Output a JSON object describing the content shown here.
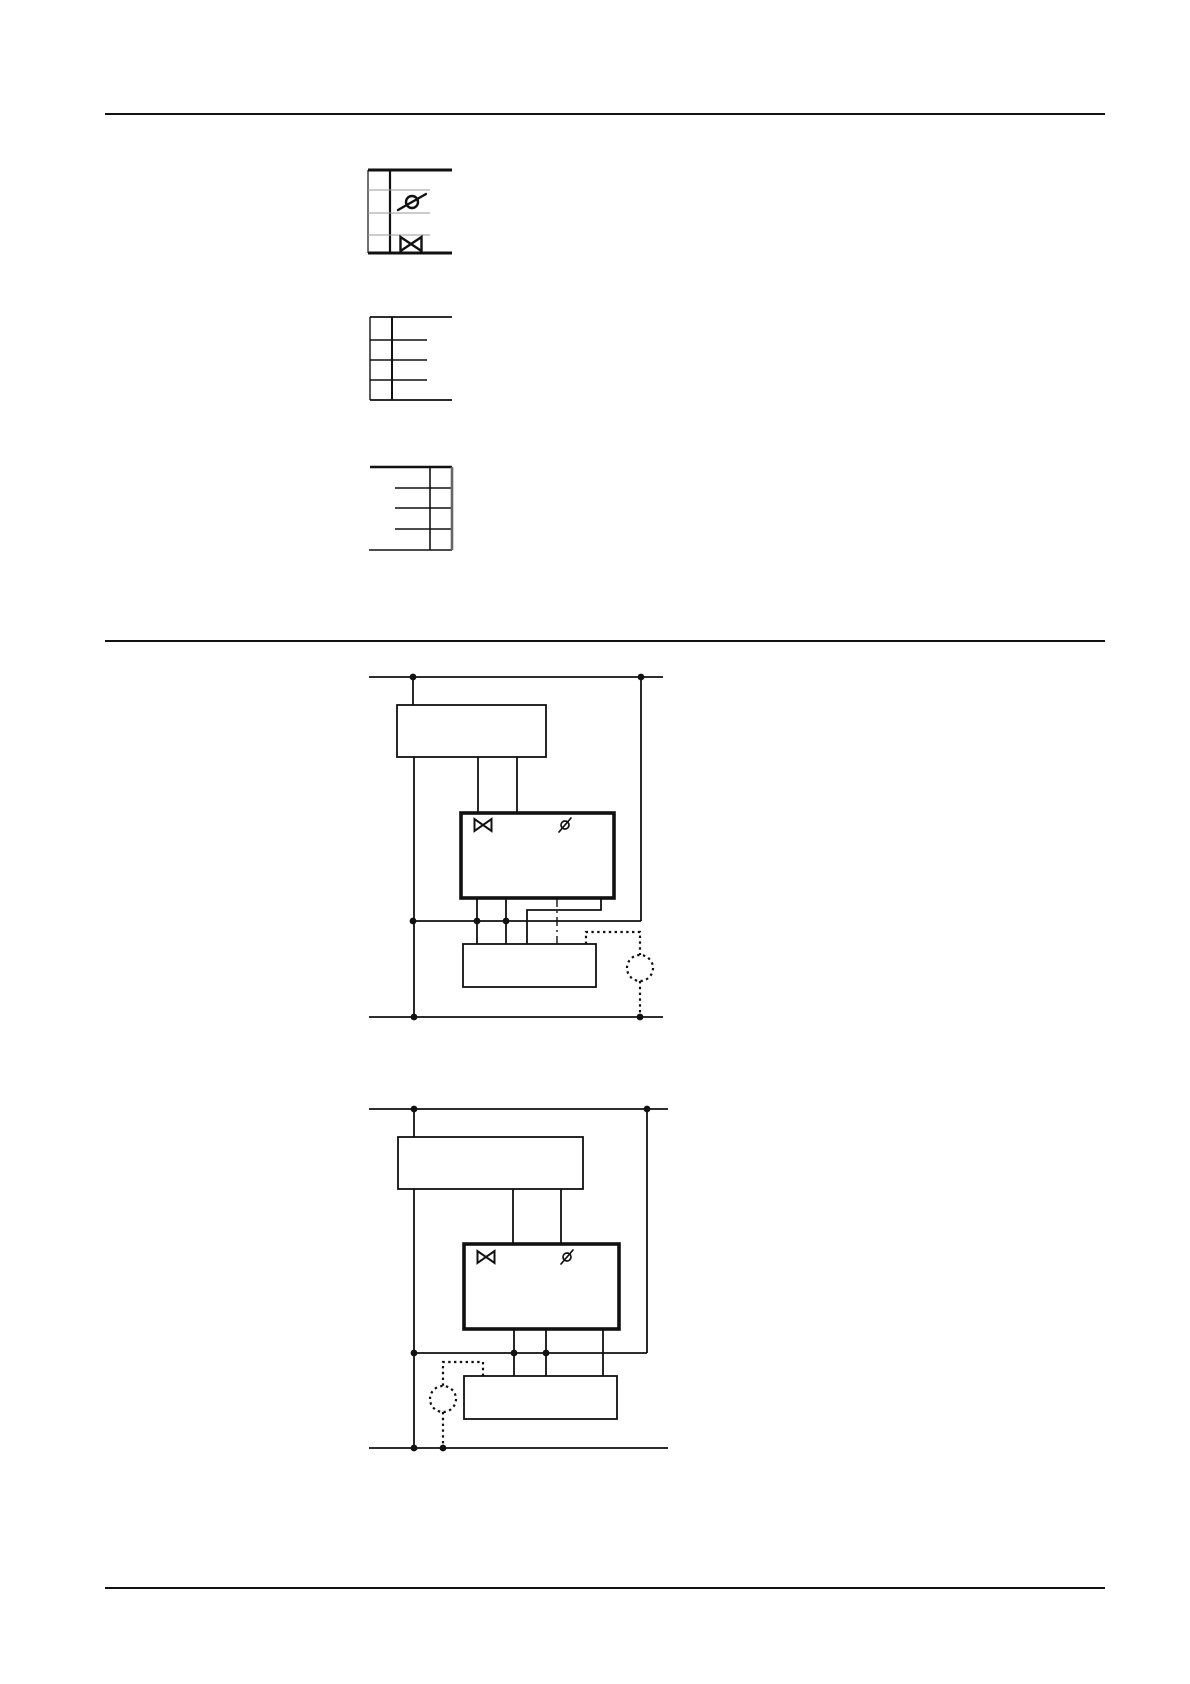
{
  "page": {
    "width": 1190,
    "height": 1684,
    "background": "#ffffff",
    "ink_color": "#111111",
    "muted_line_color": "#9a9a9a"
  },
  "section_dividers": [
    {
      "name": "divider-top",
      "x1": 105,
      "y": 114,
      "x2": 1105,
      "sw": 2
    },
    {
      "name": "divider-middle",
      "x1": 105,
      "y": 641,
      "x2": 1105,
      "sw": 2
    },
    {
      "name": "divider-bottom",
      "x1": 105,
      "y": 1588,
      "x2": 1105,
      "sw": 2
    }
  ],
  "figures": [
    {
      "name": "terminal-legend-1",
      "elements": [
        {
          "t": "line",
          "name": "top-border",
          "x1": 368,
          "y1": 170,
          "x2": 452,
          "y2": 170,
          "sw": 3
        },
        {
          "t": "line",
          "name": "bottom-border",
          "x1": 368,
          "y1": 253,
          "x2": 452,
          "y2": 253,
          "sw": 3
        },
        {
          "t": "line",
          "name": "left-border",
          "x1": 368,
          "y1": 170,
          "x2": 368,
          "y2": 253,
          "sw": 1.2
        },
        {
          "t": "line",
          "name": "terminal-rail",
          "x1": 390,
          "y1": 170,
          "x2": 390,
          "y2": 253,
          "sw": 2.2
        },
        {
          "t": "line",
          "name": "row-line",
          "x1": 368,
          "y1": 190,
          "x2": 430,
          "y2": 190,
          "sw": 1,
          "c": "#9a9a9a"
        },
        {
          "t": "line",
          "name": "row-line",
          "x1": 368,
          "y1": 213,
          "x2": 430,
          "y2": 213,
          "sw": 1,
          "c": "#9a9a9a"
        },
        {
          "t": "line",
          "name": "row-line",
          "x1": 368,
          "y1": 235,
          "x2": 430,
          "y2": 235,
          "sw": 1,
          "c": "#9a9a9a"
        },
        {
          "t": "actuator",
          "name": "actuator-symbol",
          "x": 412,
          "y": 202,
          "r": 6,
          "dx": 14,
          "dy": 8,
          "sw": 2.4
        },
        {
          "t": "valve",
          "name": "valve-symbol",
          "x": 411,
          "y": 244,
          "w": 21,
          "h": 14,
          "sw": 2.4
        }
      ]
    },
    {
      "name": "terminal-legend-2",
      "elements": [
        {
          "t": "line",
          "name": "top-border",
          "x1": 370,
          "y1": 317,
          "x2": 452,
          "y2": 317,
          "sw": 1.8
        },
        {
          "t": "line",
          "name": "row-line",
          "x1": 370,
          "y1": 340,
          "x2": 427,
          "y2": 340,
          "sw": 1.6
        },
        {
          "t": "line",
          "name": "row-line",
          "x1": 370,
          "y1": 360,
          "x2": 427,
          "y2": 360,
          "sw": 1.6
        },
        {
          "t": "line",
          "name": "row-line",
          "x1": 370,
          "y1": 380,
          "x2": 427,
          "y2": 380,
          "sw": 1.6
        },
        {
          "t": "line",
          "name": "bottom-border",
          "x1": 370,
          "y1": 400,
          "x2": 452,
          "y2": 400,
          "sw": 1.8
        },
        {
          "t": "line",
          "name": "left-border",
          "x1": 370,
          "y1": 317,
          "x2": 370,
          "y2": 400,
          "sw": 1.4
        },
        {
          "t": "line",
          "name": "terminal-rail",
          "x1": 392,
          "y1": 317,
          "x2": 392,
          "y2": 400,
          "sw": 2
        }
      ]
    },
    {
      "name": "terminal-legend-3",
      "elements": [
        {
          "t": "line",
          "name": "top-border",
          "x1": 370,
          "y1": 467,
          "x2": 452,
          "y2": 467,
          "sw": 2.6
        },
        {
          "t": "line",
          "name": "row-line",
          "x1": 395,
          "y1": 488,
          "x2": 452,
          "y2": 488,
          "sw": 1.6
        },
        {
          "t": "line",
          "name": "row-line",
          "x1": 395,
          "y1": 508,
          "x2": 452,
          "y2": 508,
          "sw": 1.6
        },
        {
          "t": "line",
          "name": "row-line",
          "x1": 395,
          "y1": 529,
          "x2": 452,
          "y2": 529,
          "sw": 1.6
        },
        {
          "t": "line",
          "name": "bottom-border",
          "x1": 369,
          "y1": 550,
          "x2": 452,
          "y2": 550,
          "sw": 1.6
        },
        {
          "t": "line",
          "name": "terminal-rail",
          "x1": 430,
          "y1": 467,
          "x2": 430,
          "y2": 550,
          "sw": 1.6
        },
        {
          "t": "line",
          "name": "right-border",
          "x1": 452,
          "y1": 467,
          "x2": 452,
          "y2": 550,
          "sw": 2.6,
          "c": "#666666"
        }
      ]
    },
    {
      "name": "wiring-diagram-1",
      "elements": [
        {
          "t": "line",
          "name": "supply-rail-top",
          "x1": 369,
          "y1": 677,
          "x2": 663,
          "y2": 677,
          "sw": 1.8
        },
        {
          "t": "line",
          "name": "wire",
          "x1": 413,
          "y1": 677,
          "x2": 413,
          "y2": 705,
          "sw": 1.8
        },
        {
          "t": "rect",
          "name": "controller-box",
          "x": 397,
          "y": 705,
          "w": 149,
          "h": 52,
          "sw": 1.8
        },
        {
          "t": "line",
          "name": "left-rail",
          "x1": 414,
          "y1": 757,
          "x2": 414,
          "y2": 1017,
          "sw": 1.8
        },
        {
          "t": "line",
          "name": "wire",
          "x1": 478,
          "y1": 757,
          "x2": 478,
          "y2": 813,
          "sw": 1.8
        },
        {
          "t": "line",
          "name": "wire",
          "x1": 517,
          "y1": 757,
          "x2": 517,
          "y2": 813,
          "sw": 1.8
        },
        {
          "t": "rect",
          "name": "actuator-unit-box",
          "x": 461,
          "y": 813,
          "w": 153,
          "h": 85,
          "sw": 3.6
        },
        {
          "t": "valve",
          "name": "valve-symbol",
          "x": 483,
          "y": 825,
          "w": 17,
          "h": 12,
          "sw": 2
        },
        {
          "t": "actuator",
          "name": "actuator-symbol",
          "x": 565,
          "y": 825,
          "r": 4,
          "dx": 6,
          "dy": 7,
          "sw": 1.7
        },
        {
          "t": "line",
          "name": "right-rail",
          "x1": 641,
          "y1": 677,
          "x2": 641,
          "y2": 921,
          "sw": 1.8
        },
        {
          "t": "line",
          "name": "junction-line",
          "x1": 413,
          "y1": 921,
          "x2": 641,
          "y2": 921,
          "sw": 1.8
        },
        {
          "t": "line",
          "name": "wire",
          "x1": 477,
          "y1": 898,
          "x2": 477,
          "y2": 944,
          "sw": 1.8
        },
        {
          "t": "line",
          "name": "wire",
          "x1": 506,
          "y1": 898,
          "x2": 506,
          "y2": 944,
          "sw": 1.8
        },
        {
          "t": "polyline",
          "name": "wire-bend",
          "pts": [
            [
              601,
              898
            ],
            [
              601,
              910
            ],
            [
              527,
              910
            ],
            [
              527,
              944
            ]
          ],
          "sw": 1.8
        },
        {
          "t": "line",
          "name": "signal-line-dashdot",
          "x1": 557,
          "y1": 898,
          "x2": 557,
          "y2": 944,
          "sw": 1.4,
          "s": "dashdot"
        },
        {
          "t": "rect",
          "name": "terminal-box",
          "x": 463,
          "y": 944,
          "w": 133,
          "h": 43,
          "sw": 1.8
        },
        {
          "t": "line",
          "name": "supply-rail-bottom",
          "x1": 369,
          "y1": 1017,
          "x2": 663,
          "y2": 1017,
          "sw": 1.8
        },
        {
          "t": "polyline",
          "name": "sensor-lead-dotted",
          "pts": [
            [
              586,
              944
            ],
            [
              586,
              932
            ],
            [
              640,
              932
            ],
            [
              640,
              955
            ]
          ],
          "sw": 2.2,
          "s": "dotted"
        },
        {
          "t": "circle",
          "name": "sensor-circle",
          "x": 640,
          "y": 968,
          "r": 13,
          "sw": 2.2,
          "s": "dotted"
        },
        {
          "t": "line",
          "name": "sensor-lead-dotted",
          "x1": 640,
          "y1": 981,
          "x2": 640,
          "y2": 1017,
          "sw": 2.2,
          "s": "dotted"
        },
        {
          "t": "dot",
          "name": "junction-dot",
          "x": 413,
          "y": 677,
          "r": 3.4
        },
        {
          "t": "dot",
          "name": "junction-dot",
          "x": 641,
          "y": 677,
          "r": 3.4
        },
        {
          "t": "dot",
          "name": "junction-dot",
          "x": 413,
          "y": 921,
          "r": 3.4
        },
        {
          "t": "dot",
          "name": "junction-dot",
          "x": 477,
          "y": 921,
          "r": 3.4
        },
        {
          "t": "dot",
          "name": "junction-dot",
          "x": 506,
          "y": 921,
          "r": 3.4
        },
        {
          "t": "dot",
          "name": "junction-dot",
          "x": 414,
          "y": 1017,
          "r": 3.4
        },
        {
          "t": "dot",
          "name": "junction-dot",
          "x": 640,
          "y": 1017,
          "r": 3.4
        }
      ]
    },
    {
      "name": "wiring-diagram-2",
      "elements": [
        {
          "t": "line",
          "name": "supply-rail-top",
          "x1": 369,
          "y1": 1109,
          "x2": 668,
          "y2": 1109,
          "sw": 1.8
        },
        {
          "t": "line",
          "name": "wire",
          "x1": 414,
          "y1": 1109,
          "x2": 414,
          "y2": 1137,
          "sw": 1.8
        },
        {
          "t": "rect",
          "name": "controller-box",
          "x": 398,
          "y": 1137,
          "w": 185,
          "h": 52,
          "sw": 1.8
        },
        {
          "t": "line",
          "name": "left-rail",
          "x1": 414,
          "y1": 1189,
          "x2": 414,
          "y2": 1448,
          "sw": 1.8
        },
        {
          "t": "line",
          "name": "wire",
          "x1": 513,
          "y1": 1189,
          "x2": 513,
          "y2": 1244,
          "sw": 1.8
        },
        {
          "t": "line",
          "name": "wire",
          "x1": 561,
          "y1": 1189,
          "x2": 561,
          "y2": 1244,
          "sw": 1.8
        },
        {
          "t": "rect",
          "name": "actuator-unit-box",
          "x": 464,
          "y": 1244,
          "w": 155,
          "h": 85,
          "sw": 3.6
        },
        {
          "t": "valve",
          "name": "valve-symbol",
          "x": 486,
          "y": 1257,
          "w": 17,
          "h": 12,
          "sw": 2
        },
        {
          "t": "actuator",
          "name": "actuator-symbol",
          "x": 567,
          "y": 1257,
          "r": 4,
          "dx": 6,
          "dy": 7,
          "sw": 1.7
        },
        {
          "t": "line",
          "name": "right-rail",
          "x1": 647,
          "y1": 1109,
          "x2": 647,
          "y2": 1353,
          "sw": 1.8
        },
        {
          "t": "line",
          "name": "junction-line",
          "x1": 414,
          "y1": 1353,
          "x2": 647,
          "y2": 1353,
          "sw": 1.8
        },
        {
          "t": "line",
          "name": "wire",
          "x1": 514,
          "y1": 1329,
          "x2": 514,
          "y2": 1376,
          "sw": 1.8
        },
        {
          "t": "line",
          "name": "wire",
          "x1": 546,
          "y1": 1329,
          "x2": 546,
          "y2": 1376,
          "sw": 1.8
        },
        {
          "t": "line",
          "name": "wire",
          "x1": 603,
          "y1": 1329,
          "x2": 603,
          "y2": 1376,
          "sw": 1.8
        },
        {
          "t": "rect",
          "name": "terminal-box",
          "x": 464,
          "y": 1376,
          "w": 153,
          "h": 43,
          "sw": 1.8
        },
        {
          "t": "line",
          "name": "supply-rail-bottom",
          "x1": 369,
          "y1": 1448,
          "x2": 668,
          "y2": 1448,
          "sw": 1.8
        },
        {
          "t": "polyline",
          "name": "sensor-lead-dotted",
          "pts": [
            [
              483,
              1376
            ],
            [
              483,
              1362
            ],
            [
              443,
              1362
            ],
            [
              443,
              1386
            ]
          ],
          "sw": 2.2,
          "s": "dotted"
        },
        {
          "t": "circle",
          "name": "sensor-circle",
          "x": 443,
          "y": 1399,
          "r": 13,
          "sw": 2.2,
          "s": "dotted"
        },
        {
          "t": "line",
          "name": "sensor-lead-dotted",
          "x1": 443,
          "y1": 1412,
          "x2": 443,
          "y2": 1448,
          "sw": 2.2,
          "s": "dotted"
        },
        {
          "t": "dot",
          "name": "junction-dot",
          "x": 414,
          "y": 1109,
          "r": 3.4
        },
        {
          "t": "dot",
          "name": "junction-dot",
          "x": 647,
          "y": 1109,
          "r": 3.4
        },
        {
          "t": "dot",
          "name": "junction-dot",
          "x": 414,
          "y": 1353,
          "r": 3.4
        },
        {
          "t": "dot",
          "name": "junction-dot",
          "x": 514,
          "y": 1353,
          "r": 3.4
        },
        {
          "t": "dot",
          "name": "junction-dot",
          "x": 546,
          "y": 1353,
          "r": 3.4
        },
        {
          "t": "dot",
          "name": "junction-dot",
          "x": 414,
          "y": 1448,
          "r": 3.4
        },
        {
          "t": "dot",
          "name": "junction-dot",
          "x": 443,
          "y": 1448,
          "r": 3.4
        }
      ]
    }
  ]
}
